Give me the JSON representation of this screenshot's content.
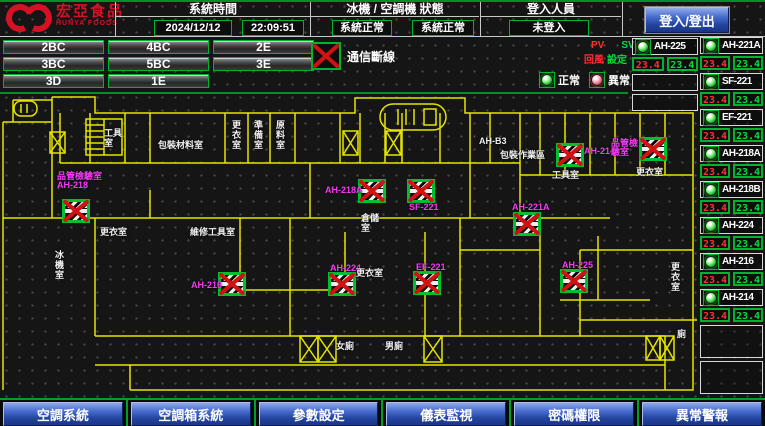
{
  "header": {
    "logo_title": "宏亞食品",
    "logo_subtitle": "HUNYA FOODS",
    "time_section_label": "系統時間",
    "date": "2024/12/12",
    "time": "22:09:51",
    "status_section_label": "冰機 / 空調機 狀態",
    "chiller_status": "系統正常",
    "ahu_status": "系統正常",
    "login_section_label": "登入人員",
    "login_user": "未登入",
    "login_button_label": "登入/登出"
  },
  "floor_buttons": {
    "rows": [
      [
        "2BC",
        "4BC",
        "2E"
      ],
      [
        "3BC",
        "5BC",
        "3E"
      ],
      [
        "3D",
        "1E"
      ]
    ]
  },
  "legend": {
    "comm_loss_label": "通信斷線",
    "normal_label": "正常",
    "abnormal_label": "異常"
  },
  "readings_header": {
    "pv_label": "PV",
    "sv_label": "SV",
    "pv_desc": "回風",
    "sv_desc": "設定"
  },
  "units": {
    "column_a": [
      {
        "name": "AH-225",
        "pv": "23.4",
        "sv": "23.4",
        "status": "normal"
      }
    ],
    "column_a_empty_slots": 2,
    "column_b": [
      {
        "name": "AH-221A",
        "pv": "23.4",
        "sv": "23.4",
        "status": "normal"
      },
      {
        "name": "SF-221",
        "pv": "23.4",
        "sv": "23.4",
        "status": "normal"
      },
      {
        "name": "EF-221",
        "pv": "23.4",
        "sv": "23.4",
        "status": "normal"
      },
      {
        "name": "AH-218A",
        "pv": "23.4",
        "sv": "23.4",
        "status": "normal"
      },
      {
        "name": "AH-218B",
        "pv": "23.4",
        "sv": "23.4",
        "status": "normal"
      },
      {
        "name": "AH-224",
        "pv": "23.4",
        "sv": "23.4",
        "status": "normal"
      },
      {
        "name": "AH-216",
        "pv": "23.4",
        "sv": "23.4",
        "status": "normal"
      },
      {
        "name": "AH-214",
        "pv": "23.4",
        "sv": "23.4",
        "status": "normal"
      }
    ],
    "column_b_empty_slots": 2
  },
  "floorplan": {
    "devices": [
      {
        "id": "AH-218",
        "label_lines": [
          "品管檢驗室",
          "AH-218"
        ],
        "icon": [
          62,
          199
        ],
        "label": [
          57,
          172
        ]
      },
      {
        "id": "AH-216",
        "label_lines": [
          "AH-216"
        ],
        "icon": [
          218,
          272
        ],
        "label": [
          191,
          281
        ]
      },
      {
        "id": "AH-218A",
        "label_lines": [
          "AH-218A"
        ],
        "icon": [
          358,
          179
        ],
        "label": [
          325,
          186
        ]
      },
      {
        "id": "SF-221",
        "label_lines": [
          "SF-221"
        ],
        "icon": [
          407,
          179
        ],
        "label": [
          409,
          203
        ]
      },
      {
        "id": "AH-221A",
        "label_lines": [
          "AH-221A"
        ],
        "icon": [
          513,
          212
        ],
        "label": [
          512,
          203
        ]
      },
      {
        "id": "AH-225",
        "label_lines": [
          "AH-225"
        ],
        "icon": [
          560,
          269
        ],
        "label": [
          562,
          261
        ]
      },
      {
        "id": "AH-214",
        "label_lines": [
          "AH-214"
        ],
        "icon": [
          556,
          143
        ],
        "label": [
          584,
          147
        ],
        "sublabel": "工具室",
        "sub": [
          552,
          170
        ]
      },
      {
        "id": "AH-218B",
        "label_lines": [
          "品管檢",
          "驗室"
        ],
        "icon": [
          639,
          137
        ],
        "label": [
          611,
          139
        ],
        "sublabel": "更衣室",
        "sub": [
          636,
          167
        ]
      },
      {
        "id": "AH-224",
        "label_lines": [
          "AH-224"
        ],
        "icon": [
          328,
          272
        ],
        "label": [
          330,
          264
        ]
      },
      {
        "id": "EF-221",
        "label_lines": [
          "EF-221"
        ],
        "icon": [
          413,
          271
        ],
        "label": [
          416,
          263
        ]
      }
    ],
    "room_labels": [
      {
        "text": "工具室",
        "x": 104,
        "y": 128,
        "w": 22
      },
      {
        "text": "包裝材料室",
        "x": 158,
        "y": 140
      },
      {
        "text": "更衣室",
        "x": 231,
        "y": 120,
        "v": 1
      },
      {
        "text": "準備室",
        "x": 253,
        "y": 120,
        "v": 1
      },
      {
        "text": "原料室",
        "x": 275,
        "y": 120,
        "v": 1
      },
      {
        "text": "AH-B3",
        "x": 479,
        "y": 136
      },
      {
        "text": "包裝作業區",
        "x": 500,
        "y": 150
      },
      {
        "text": "倉儲室",
        "x": 361,
        "y": 213,
        "w": 22
      },
      {
        "text": "更衣室",
        "x": 356,
        "y": 268
      },
      {
        "text": "維修工具室",
        "x": 190,
        "y": 227
      },
      {
        "text": "更衣室",
        "x": 100,
        "y": 227
      },
      {
        "text": "冰機室",
        "x": 54,
        "y": 250,
        "v": 1
      },
      {
        "text": "女廁",
        "x": 336,
        "y": 341
      },
      {
        "text": "男廁",
        "x": 385,
        "y": 341
      },
      {
        "text": "更衣室",
        "x": 670,
        "y": 262,
        "v": 1
      },
      {
        "text": "廁",
        "x": 677,
        "y": 329
      }
    ]
  },
  "bottom_nav": [
    "空調系統",
    "空調箱系統",
    "參數設定",
    "儀表監視",
    "密碼權限",
    "異常警報"
  ]
}
